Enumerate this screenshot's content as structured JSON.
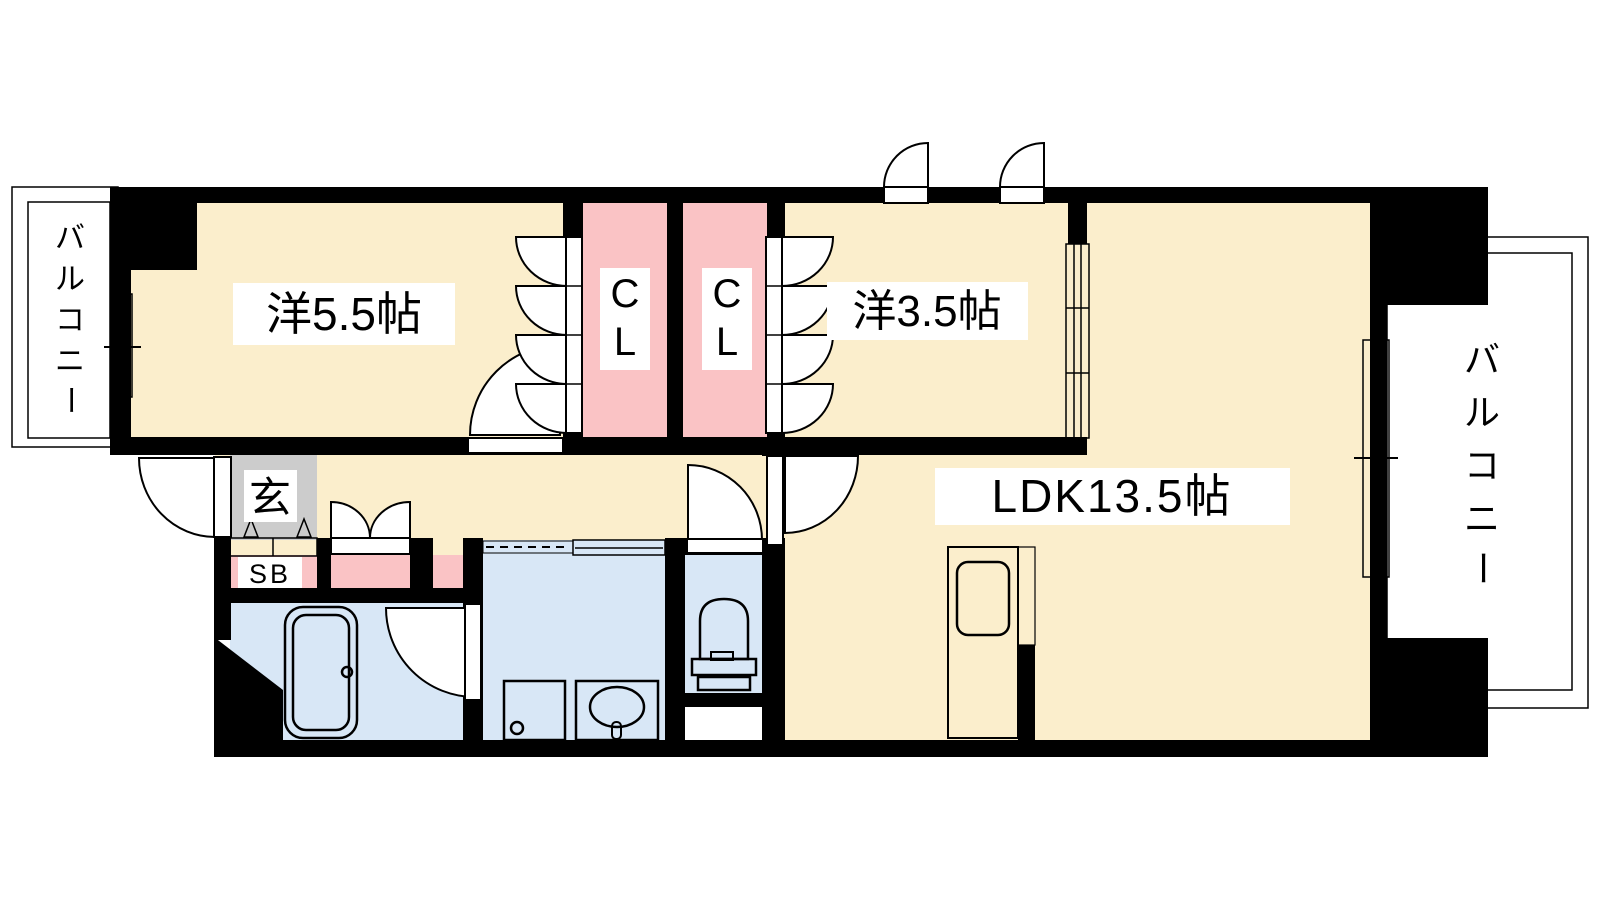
{
  "title": "間取り図",
  "colors": {
    "wall": "#000000",
    "room_cream": "#FBEECC",
    "closet_pink": "#FAC3C5",
    "water_blue": "#D8E7F6",
    "balcony_gray": "#D3D3D3",
    "entrance_gray": "#CCCCCC",
    "door_lavender": "#E4DCF0",
    "line": "#000000",
    "label_bg": "#FFFFFF"
  },
  "labels": {
    "bedroom1": {
      "text": "洋5.5帖"
    },
    "bedroom2": {
      "text": "洋3.5帖"
    },
    "ldk": {
      "text": "LDK13.5帖"
    },
    "closet_left": {
      "chars": [
        "C",
        "L"
      ]
    },
    "closet_right": {
      "chars": [
        "C",
        "L"
      ]
    },
    "entrance": {
      "text": "玄"
    },
    "shoe_box": {
      "text": "SB"
    },
    "balcony_left": {
      "chars": [
        "バ",
        "ル",
        "コ",
        "ニ",
        "ー"
      ]
    },
    "balcony_right": {
      "chars": [
        "バ",
        "ル",
        "コ",
        "ニ",
        "ー"
      ]
    }
  }
}
